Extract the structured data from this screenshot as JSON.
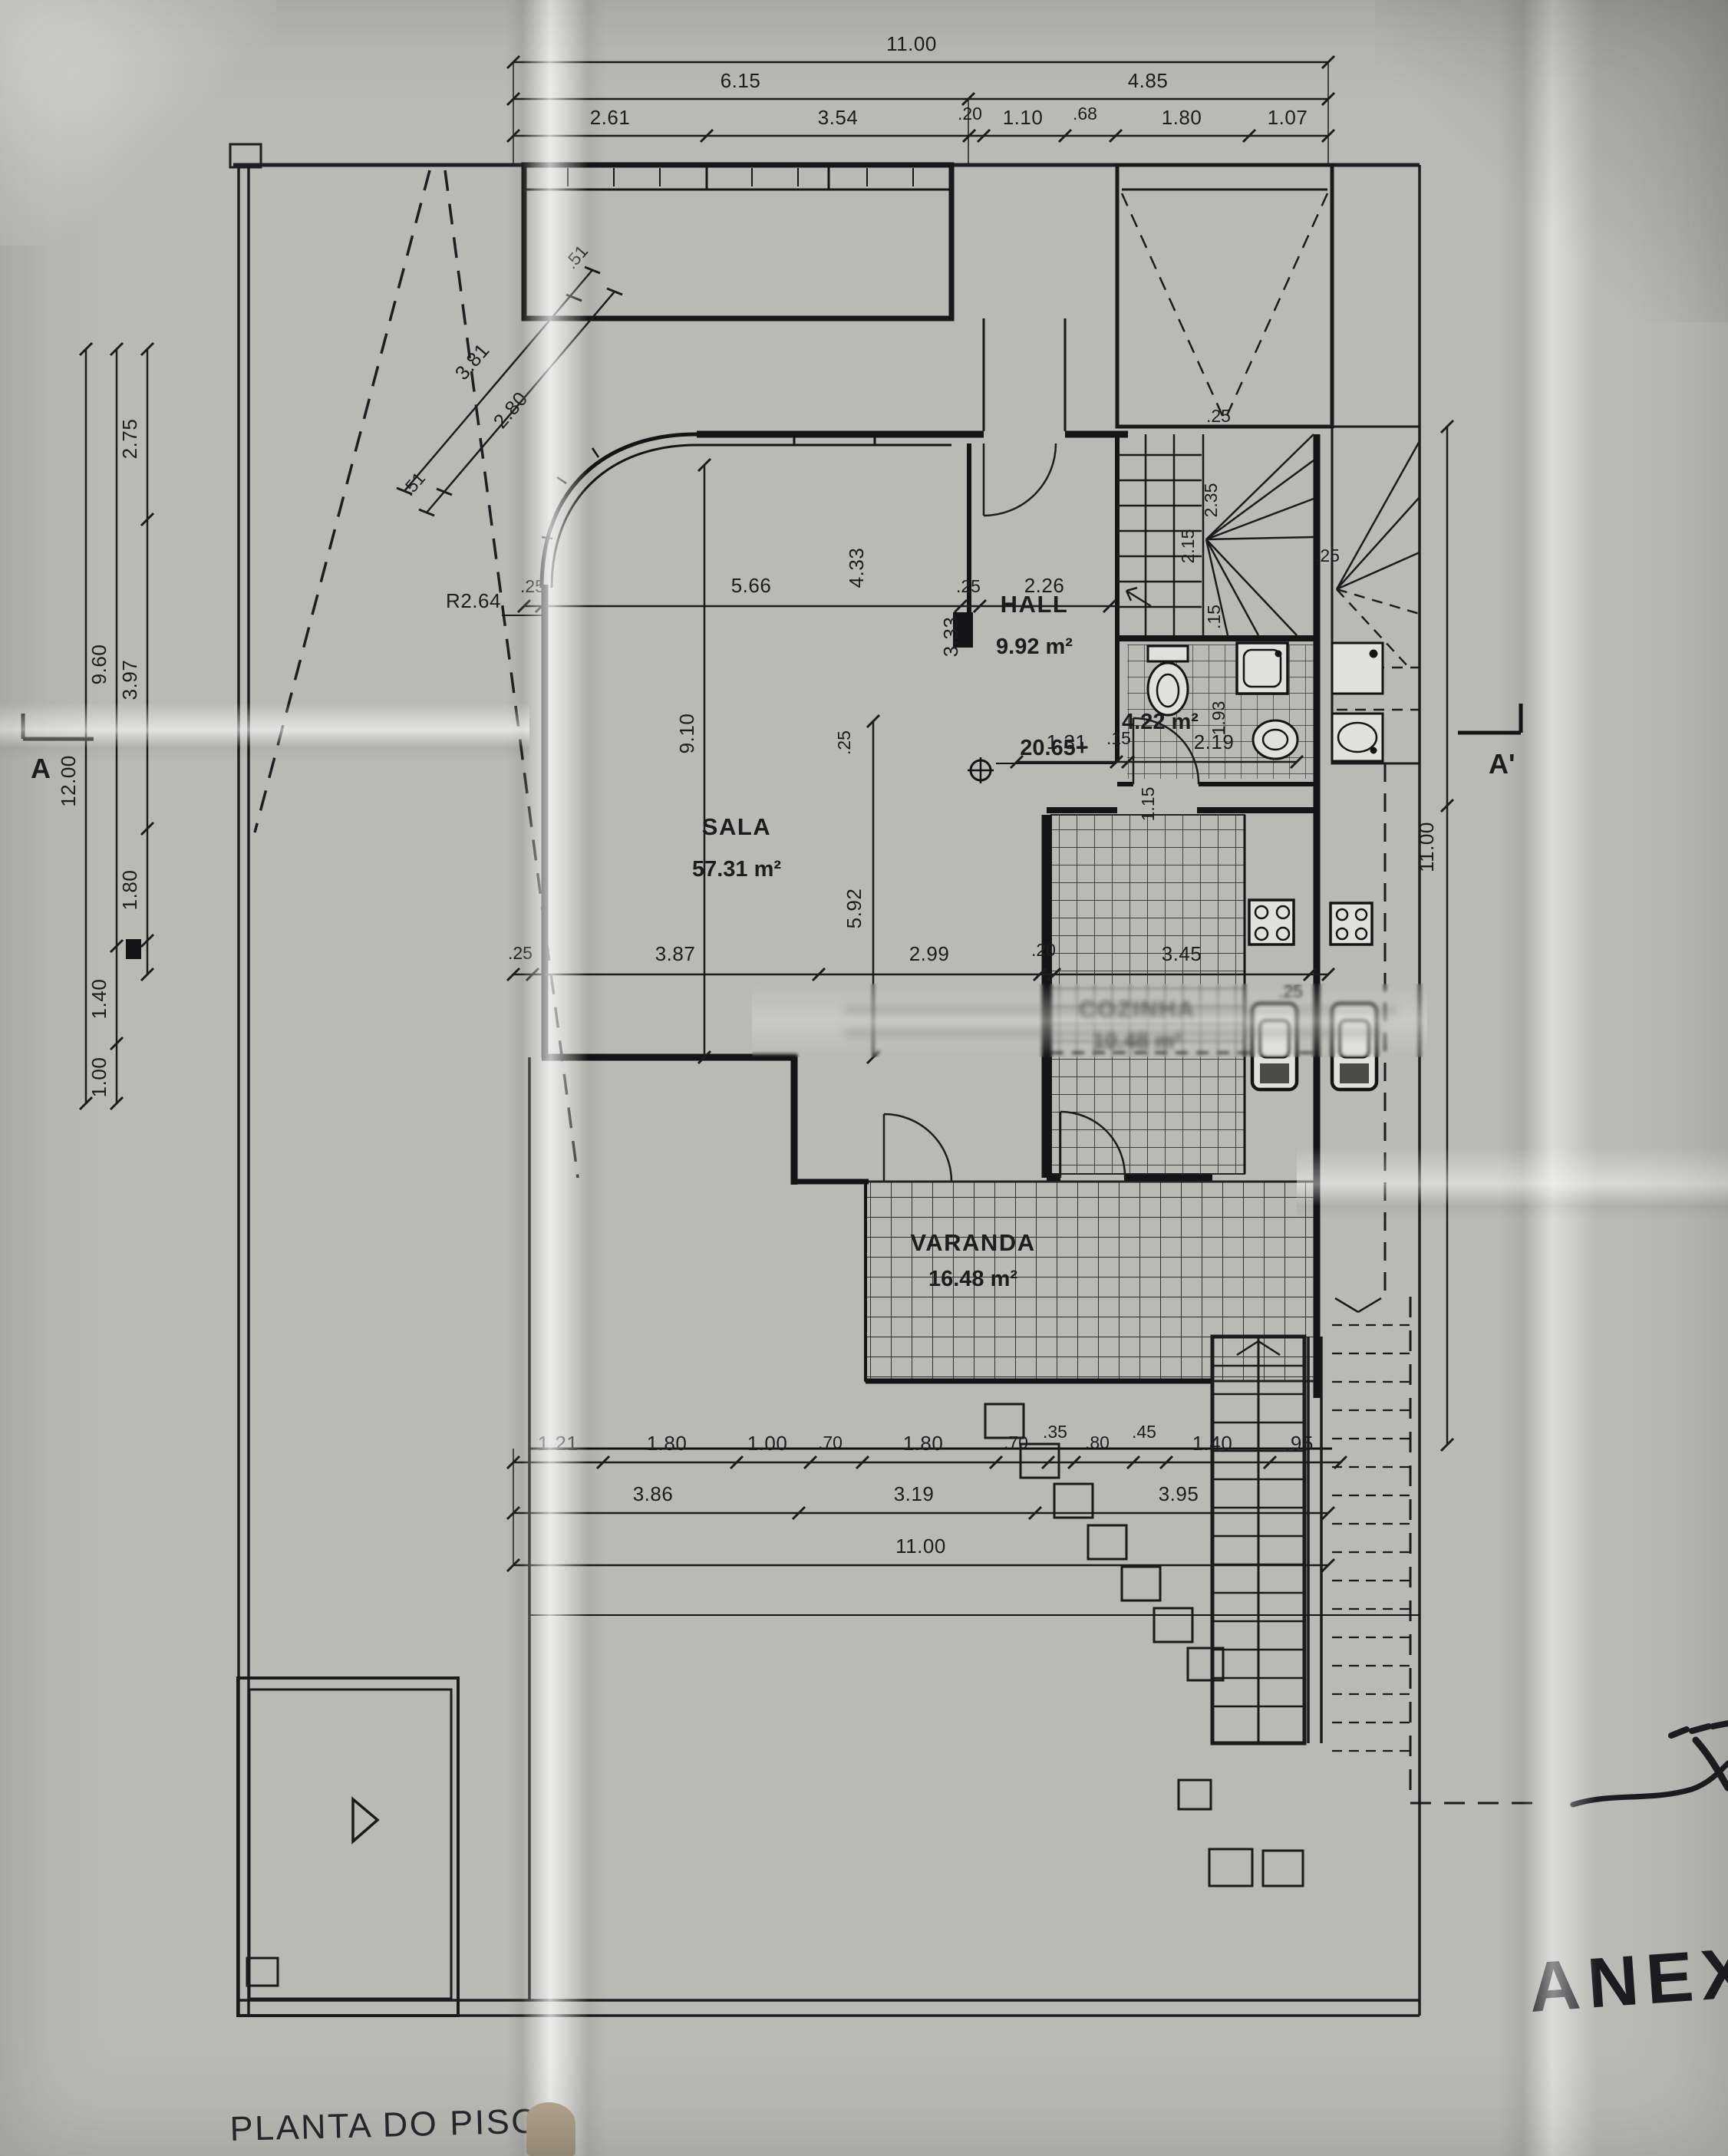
{
  "document": {
    "title": "PLANTA DO PISO 0",
    "annotation": "ANEXO"
  },
  "section_markers": {
    "left": "A",
    "right": "A'"
  },
  "rooms": {
    "hall": {
      "name": "HALL",
      "area": "9.92 m²"
    },
    "sala": {
      "name": "SALA",
      "area": "57.31 m²"
    },
    "cozinha": {
      "name": "COZINHA",
      "area": "10.48 m²"
    },
    "varanda": {
      "name": "VARANDA",
      "area": "16.48 m²"
    },
    "wc": {
      "area": "4.22 m²"
    }
  },
  "annotations": {
    "level": "20.65+",
    "radius": "R2.64"
  },
  "dims": {
    "top1": [
      "11.00"
    ],
    "top2": [
      "6.15",
      "4.85"
    ],
    "top3": [
      "2.61",
      "3.54",
      ".20",
      "1.10",
      ".68",
      "1.80",
      "1.07"
    ],
    "left_outer": [
      "12.00"
    ],
    "left_mid": [
      "9.60",
      "1.40",
      "1.00"
    ],
    "left_inner": [
      "2.75",
      "3.97",
      "1.80"
    ],
    "diagonal": [
      "3.81",
      "2.80",
      ".51",
      ".51"
    ],
    "upper": [
      ".25",
      "5.66",
      ".25",
      "2.26",
      "4.33",
      "3.33"
    ],
    "sala": [
      "9.10",
      "5.92",
      ".25"
    ],
    "middle": [
      ".25",
      "3.87",
      "2.99",
      ".20",
      "3.45",
      ".25"
    ],
    "hall_chain": [
      "1.31",
      ".15",
      "2.19"
    ],
    "bath": [
      "1.93",
      "1.15"
    ],
    "stairs": [
      "2.35",
      "2.15",
      ".15",
      ".25",
      ".25"
    ],
    "right": [
      "11.00"
    ],
    "bottom1": [
      "1.21",
      "1.80",
      "1.00",
      ".70",
      "1.80",
      ".70",
      ".35",
      ".80",
      ".45",
      "1.40",
      ".95"
    ],
    "bottom2": [
      "3.86",
      "3.19",
      "3.95"
    ],
    "bottom3": [
      "11.00"
    ]
  }
}
